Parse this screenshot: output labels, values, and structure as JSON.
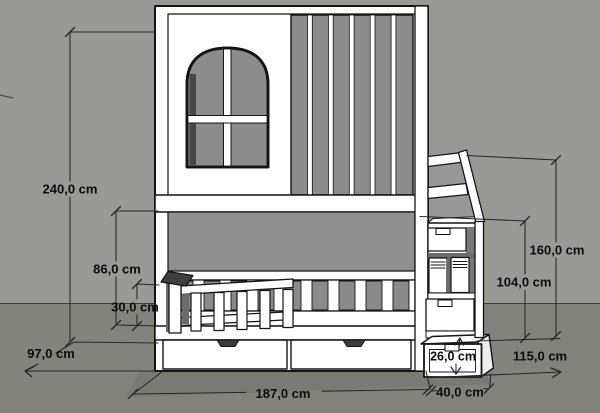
{
  "meta": {
    "type": "technical-drawing",
    "subject": "bunk bed with storage stairs, front elevation with dimensions",
    "unit": "cm"
  },
  "canvas": {
    "width": 600,
    "height": 413
  },
  "colors": {
    "wall": "#999996",
    "floor": "#83837d",
    "bed_fill": "#ffffff",
    "panel_gray": "#8c8c8c",
    "recess_gray": "#8f8f8f",
    "line": "#141414",
    "dimension_line": "#262626",
    "text": "#0c0c0c"
  },
  "dimensions": {
    "total_height": {
      "label": "240,0 cm",
      "value_cm": 240.0
    },
    "underbed_clearance": {
      "label": "86,0 cm",
      "value_cm": 86.0
    },
    "guard_rail_height": {
      "label": "30,0 cm",
      "value_cm": 30.0
    },
    "bed_depth": {
      "label": "97,0 cm",
      "value_cm": 97.0
    },
    "bed_length": {
      "label": "187,0 cm",
      "value_cm": 187.0
    },
    "step_width": {
      "label": "40,0 cm",
      "value_cm": 40.0
    },
    "step_height": {
      "label": "26,0 cm",
      "value_cm": 26.0
    },
    "stairs_depth": {
      "label": "115,0 cm",
      "value_cm": 115.0
    },
    "stairs_height": {
      "label": "104,0 cm",
      "value_cm": 104.0
    },
    "handrail_height": {
      "label": "160,0 cm",
      "value_cm": 160.0
    }
  }
}
